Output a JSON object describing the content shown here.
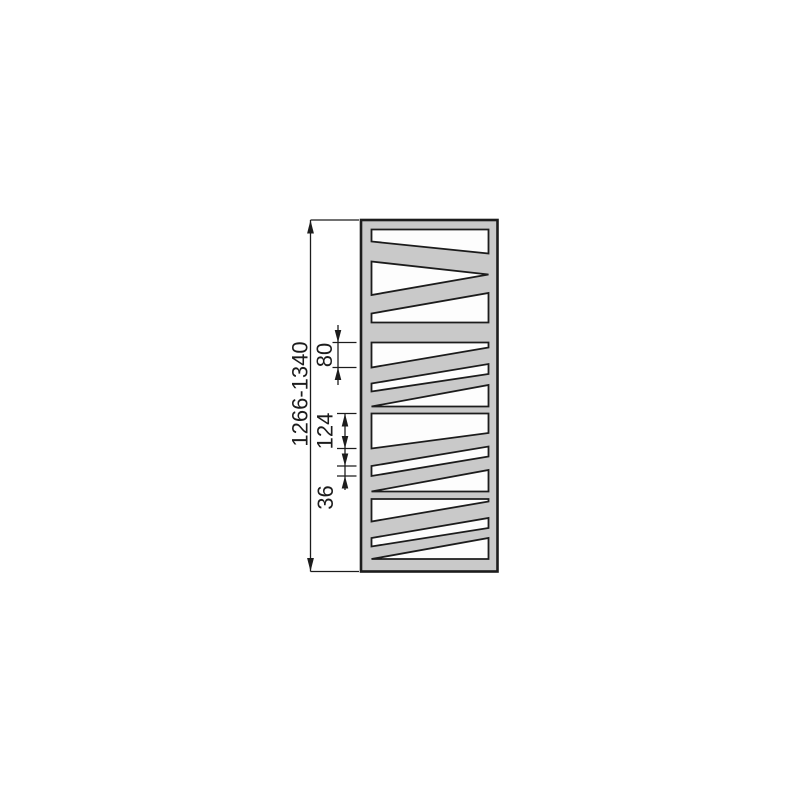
{
  "drawing": {
    "dimensions": {
      "overall_height": "1266-1340",
      "dim_80": "80",
      "dim_124": "124",
      "dim_36": "36"
    },
    "radiator": {
      "sections": 4,
      "cutouts_per_section": 3
    },
    "colors": {
      "background": "#ffffff",
      "body_fill": "#c9c9c9",
      "cutout_fill": "#fdfdfd",
      "line": "#1c1c1c"
    }
  }
}
